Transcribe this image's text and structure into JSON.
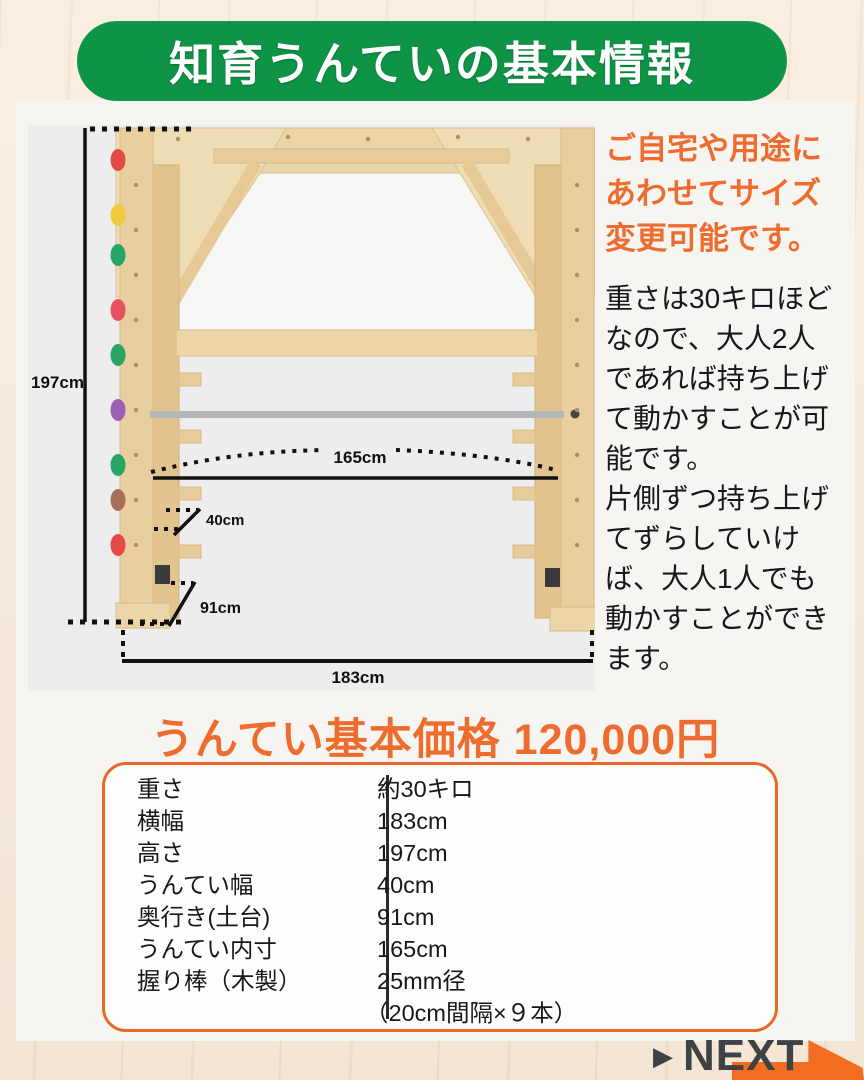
{
  "colors": {
    "green": "#0f9447",
    "orange": "#ed6c2e",
    "orange_border": "#e8682a",
    "arrow_orange": "#f26d21",
    "next_text": "#3e4246",
    "photo_bg": "#ededed"
  },
  "header": {
    "title": "知育うんていの基本情報"
  },
  "diagram": {
    "labels": {
      "height": "197cm",
      "inner_span": "165cm",
      "rung_width": "40cm",
      "base_depth": "91cm",
      "total_width": "183cm"
    },
    "hold_colors": [
      "#e64747",
      "#f0c93c",
      "#27a567",
      "#e8515e",
      "#27a567",
      "#9c5fb5",
      "#27a567",
      "#a67057",
      "#e64747"
    ]
  },
  "right_panel": {
    "highlight_lines": [
      "ご自宅や用途に",
      "あわせてサイズ",
      "変更可能です。"
    ],
    "body_lines": [
      "重さは30キロほど",
      "なので、大人2人",
      "であれば持ち上げ",
      "て動かすことが可",
      "能です。",
      "片側ずつ持ち上げ",
      "てずらしていけ",
      "ば、大人1人でも",
      "動かすことができ",
      "ます。"
    ]
  },
  "price": {
    "heading": "うんてい基本価格 120,000円"
  },
  "spec_table": {
    "rows": [
      {
        "label": "重さ",
        "value": "約30キロ"
      },
      {
        "label": "横幅",
        "value": "183cm"
      },
      {
        "label": "高さ",
        "value": "197cm"
      },
      {
        "label": "うんてい幅",
        "value": "40cm"
      },
      {
        "label": "奥行き(土台)",
        "value": "91cm"
      },
      {
        "label": "うんてい内寸",
        "value": "165cm"
      },
      {
        "label": "握り棒（木製）",
        "value": "25mm径",
        "value_note": "（20cm間隔×９本）"
      }
    ]
  },
  "next": {
    "triangle": "▶",
    "label": "NEXT"
  }
}
